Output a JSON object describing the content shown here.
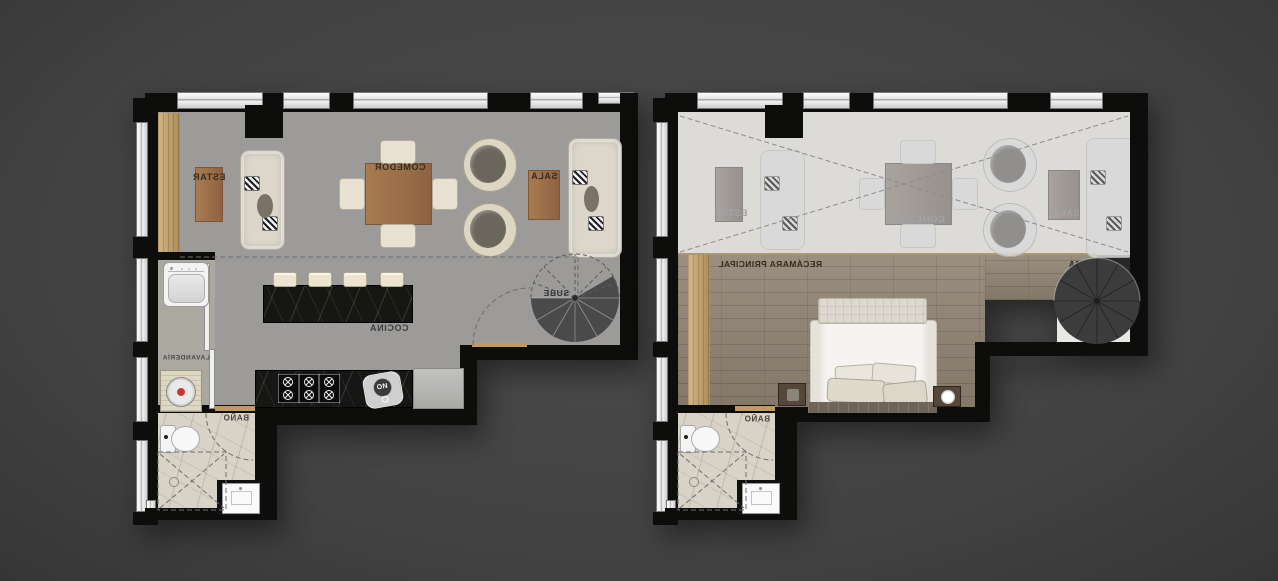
{
  "plans": {
    "lower": {
      "estar": "ESTAR",
      "comedor": "COMEDOR",
      "sala": "SALA",
      "cocina": "COCINA",
      "sube": "SUBE",
      "lavanderia": "LAVANDERÍA",
      "bano": "BAÑO",
      "sink_mark": "ON"
    },
    "upper": {
      "estar": "ESTAR",
      "comedor": "COMEDOR",
      "sala": "SALA",
      "recamara": "RECÁMARA PRINCIPAL",
      "baja": "BAJA",
      "bano": "BAÑO"
    }
  },
  "colors": {
    "wall": "#0d0d0c",
    "floor_gray": "#9c9b99",
    "ghost_floor": "#dcdbd8",
    "wood_accent": "#c49e63",
    "table_wood": "#a0764e",
    "counter_marble": "#161614",
    "bedroom_wood": "#8e8271",
    "label_dark": "#352c1f",
    "label_ghost": "#a3a3a3",
    "stair_dark": "#454545"
  }
}
